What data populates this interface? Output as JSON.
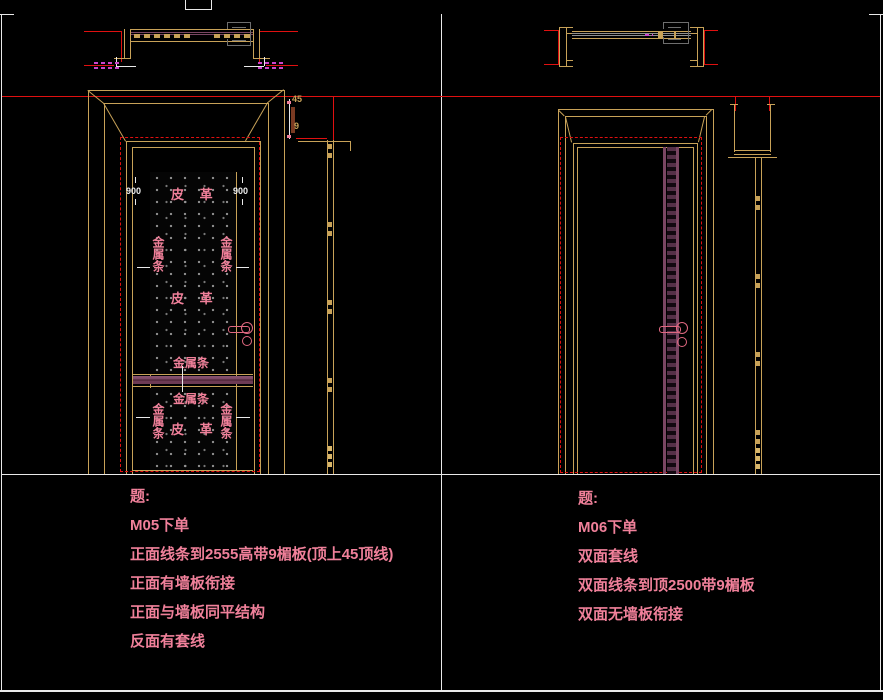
{
  "left_view": {
    "notes": [
      "题:",
      "M05下单",
      "正面线条到2555高带9楣板(顶上45顶线)",
      "正面有墙板衔接",
      "正面与墙板同平结构",
      "反面有套线"
    ],
    "panel_labels": {
      "leather": "皮 革",
      "metal_strip": "金属条"
    },
    "dims": {
      "stile_width": "900",
      "top_line": "45",
      "lintel": "9"
    }
  },
  "right_view": {
    "notes": [
      "题:",
      "M06下单",
      "双面套线",
      "双面线条到顶2500带9楣板",
      "双面无墙板衔接"
    ]
  },
  "colors": {
    "line_tan": "#c8a258",
    "wall_red": "#e01010",
    "text_pink": "#f0809a",
    "rail_purple": "#7a4663",
    "hatch_magenta": "#cc44cc",
    "border_white": "#e9e9e9"
  }
}
